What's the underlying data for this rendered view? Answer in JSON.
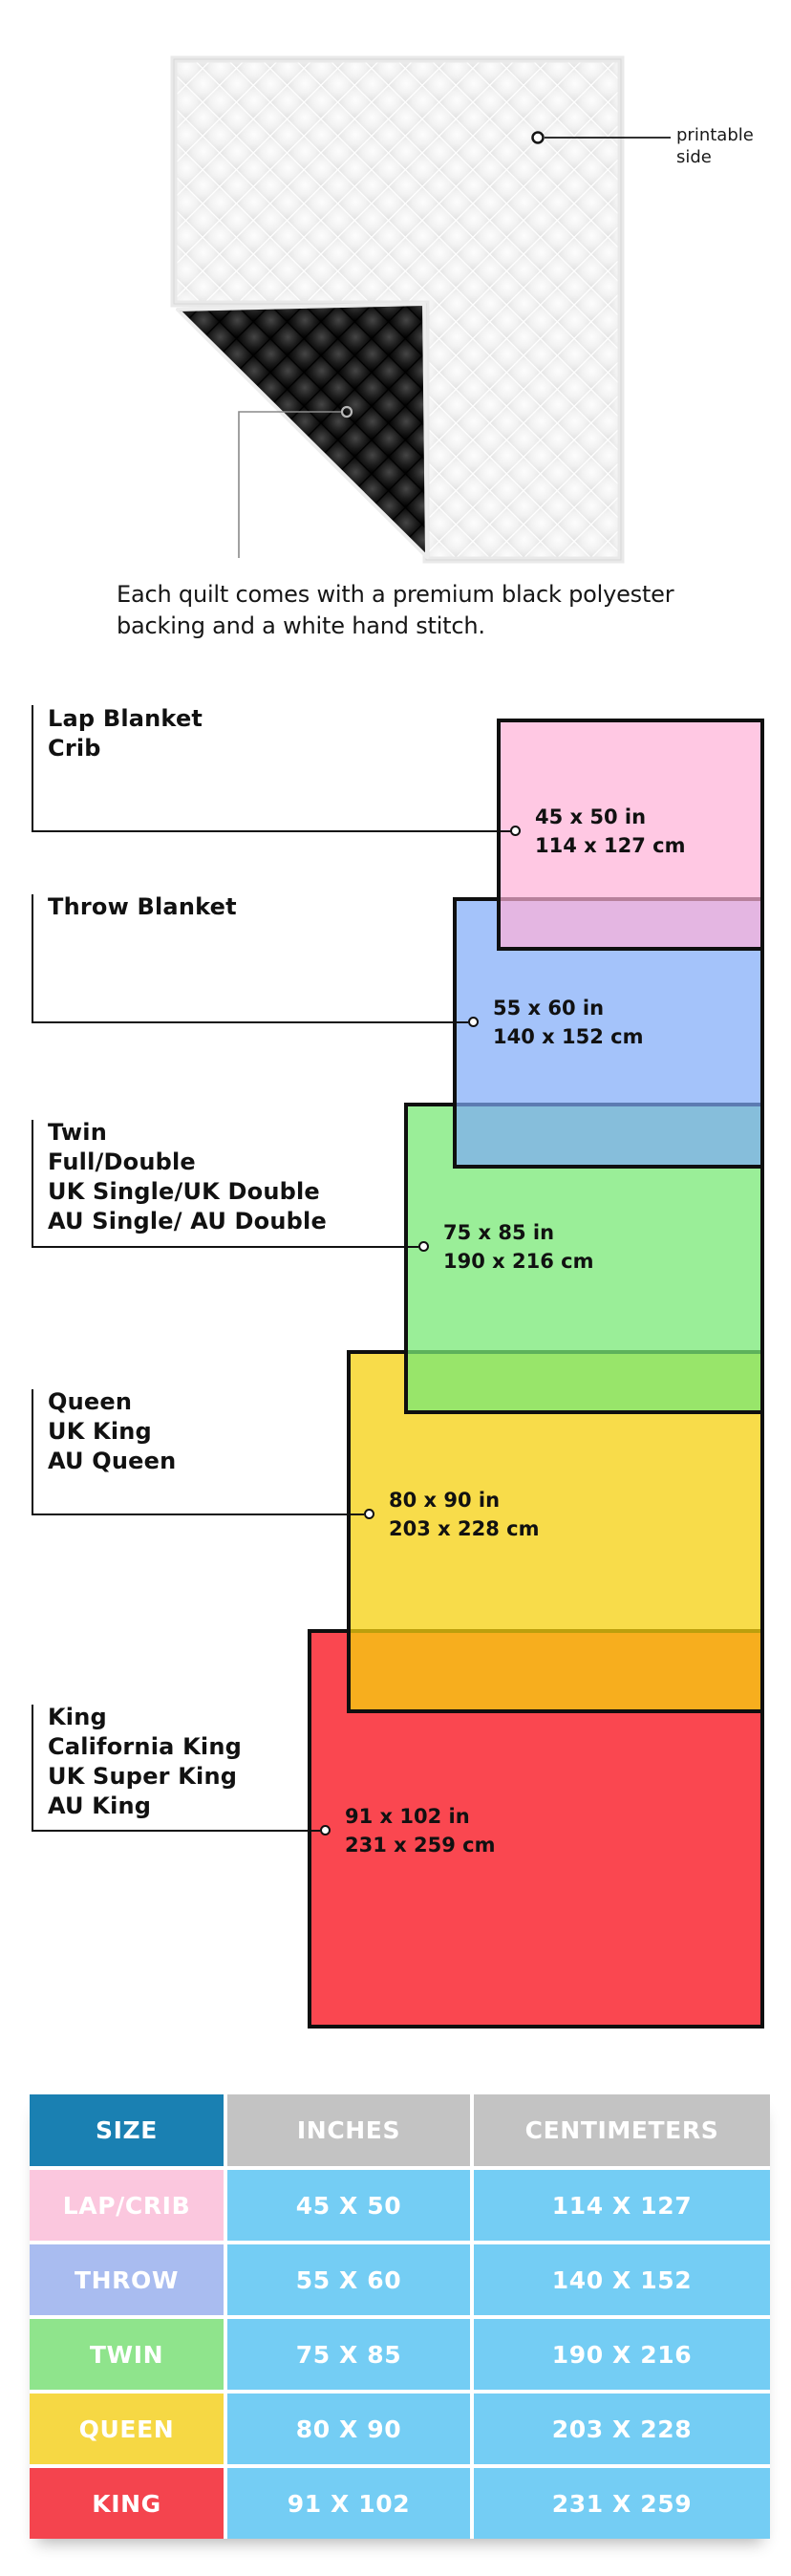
{
  "page": {
    "background": "#ffffff"
  },
  "illustration": {
    "printable_label": "printable side",
    "caption": "Each quilt comes with a premium black polyester backing and a white hand stitch."
  },
  "diagram": {
    "border_color": "#0f0f0f",
    "items": [
      {
        "id": "lap-crib",
        "names": [
          "Lap Blanket",
          "Crib"
        ],
        "inches": "45 x 50 in",
        "cm": "114 x 127 cm",
        "fill": "#FFC8E3",
        "fill_rgba": "rgba(255,176,215,0.7)"
      },
      {
        "id": "throw",
        "names": [
          "Throw Blanket"
        ],
        "inches": "55 x 60 in",
        "cm": "140 x 152 cm",
        "fill": "#A4C3FA",
        "fill_rgba": "rgba(125,169,248,0.7)"
      },
      {
        "id": "twin",
        "names": [
          "Twin",
          "Full/Double",
          "UK Single/UK Double",
          "AU Single/ AU Double"
        ],
        "inches": "75 x 85 in",
        "cm": "190 x 216 cm",
        "fill": "#9AEE98",
        "fill_rgba": "rgba(120,232,118,0.75)"
      },
      {
        "id": "queen",
        "names": [
          "Queen",
          "UK King",
          "AU Queen"
        ],
        "inches": "80 x 90 in",
        "cm": "203 x 228 cm",
        "fill": "#F8DC4A",
        "fill_rgba": "rgba(246,208,14,0.75)"
      },
      {
        "id": "king",
        "names": [
          "King",
          "California King",
          "UK Super King",
          "AU King"
        ],
        "inches": "91 x 102 in",
        "cm": "231 x 259 cm",
        "fill": "#FA4750",
        "fill_rgba": "rgba(250,71,80,1)"
      }
    ]
  },
  "table": {
    "headers": [
      "SIZE",
      "INCHES",
      "CENTIMETERS"
    ],
    "colors": {
      "size_header_bg": "#1A80B2",
      "header_bg": "#C3C3C3",
      "value_bg": "#74CDF4",
      "text": "#FFFFFF"
    },
    "rows": [
      {
        "size": "LAP/CRIB",
        "inches": "45 X 50",
        "cm": "114 X 127",
        "color": "#FBC7DE"
      },
      {
        "size": "THROW",
        "inches": "55 X 60",
        "cm": "140 X 152",
        "color": "#A9BCF0"
      },
      {
        "size": "TWIN",
        "inches": "75 X 85",
        "cm": "190 X 216",
        "color": "#8FE48C"
      },
      {
        "size": "QUEEN",
        "inches": "80 X 90",
        "cm": "203 X 228",
        "color": "#F6D844"
      },
      {
        "size": "KING",
        "inches": "91 X 102",
        "cm": "231 X 259",
        "color": "#F4444E"
      }
    ]
  }
}
